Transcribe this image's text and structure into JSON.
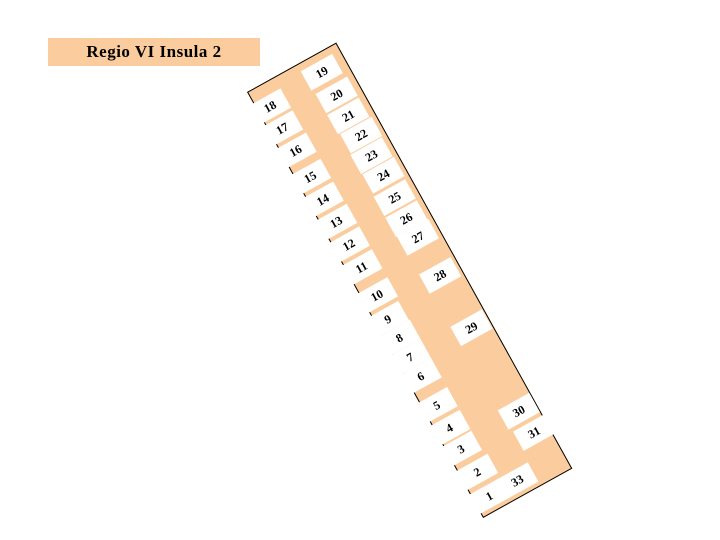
{
  "title": "Regio VI Insula 2",
  "colors": {
    "insula_fill": "#FBCD9E",
    "outline": "#000000",
    "entrance_label_bg": "#FFFFFF",
    "text": "#000000",
    "background": "#FFFFFF"
  },
  "plan": {
    "name": "insula-plan",
    "rotation_deg": -29,
    "strip_size": {
      "width": 102,
      "height": 487
    },
    "entrance_box_size": {
      "width": 36,
      "height": 22
    },
    "entrances": [
      {
        "label": "1",
        "side": "west",
        "x": 15,
        "y": 470
      },
      {
        "label": "2",
        "side": "west",
        "x": 16,
        "y": 443
      },
      {
        "label": "3",
        "side": "west",
        "x": 13,
        "y": 415
      },
      {
        "label": "4",
        "side": "west",
        "x": 13,
        "y": 391
      },
      {
        "label": "5",
        "side": "west",
        "x": 13,
        "y": 365
      },
      {
        "label": "6",
        "side": "west",
        "x": 13,
        "y": 332
      },
      {
        "label": "7",
        "side": "west",
        "x": 13,
        "y": 310
      },
      {
        "label": "8",
        "side": "west",
        "x": 13,
        "y": 288
      },
      {
        "label": "9",
        "side": "west",
        "x": 12,
        "y": 266
      },
      {
        "label": "10",
        "side": "west",
        "x": 14,
        "y": 240
      },
      {
        "label": "11",
        "side": "west",
        "x": 14,
        "y": 208
      },
      {
        "label": "12",
        "side": "west",
        "x": 14,
        "y": 182
      },
      {
        "label": "13",
        "side": "west",
        "x": 14,
        "y": 156
      },
      {
        "label": "14",
        "side": "west",
        "x": 13,
        "y": 130
      },
      {
        "label": "15",
        "side": "west",
        "x": 13,
        "y": 104
      },
      {
        "label": "16",
        "side": "west",
        "x": 13,
        "y": 74
      },
      {
        "label": "17",
        "side": "west",
        "x": 12,
        "y": 48
      },
      {
        "label": "18",
        "side": "west",
        "x": 12,
        "y": 23
      },
      {
        "label": "19",
        "side": "east",
        "x": 74,
        "y": 18
      },
      {
        "label": "20",
        "side": "east",
        "x": 76,
        "y": 45
      },
      {
        "label": "21",
        "side": "east",
        "x": 76,
        "y": 69
      },
      {
        "label": "22",
        "side": "east",
        "x": 78,
        "y": 92
      },
      {
        "label": "23",
        "side": "east",
        "x": 77,
        "y": 115
      },
      {
        "label": "24",
        "side": "east",
        "x": 78,
        "y": 138
      },
      {
        "label": "25",
        "side": "east",
        "x": 77,
        "y": 163
      },
      {
        "label": "26",
        "side": "east",
        "x": 77,
        "y": 187
      },
      {
        "label": "27",
        "side": "east",
        "x": 78,
        "y": 209
      },
      {
        "label": "28",
        "side": "interior",
        "x": 79,
        "y": 253
      },
      {
        "label": "29",
        "side": "interior",
        "x": 81,
        "y": 314
      },
      {
        "label": "30",
        "side": "east",
        "x": 82,
        "y": 410
      },
      {
        "label": "31",
        "side": "east",
        "x": 85,
        "y": 436
      },
      {
        "label": "33",
        "side": "south",
        "x": 47,
        "y": 470
      }
    ]
  }
}
